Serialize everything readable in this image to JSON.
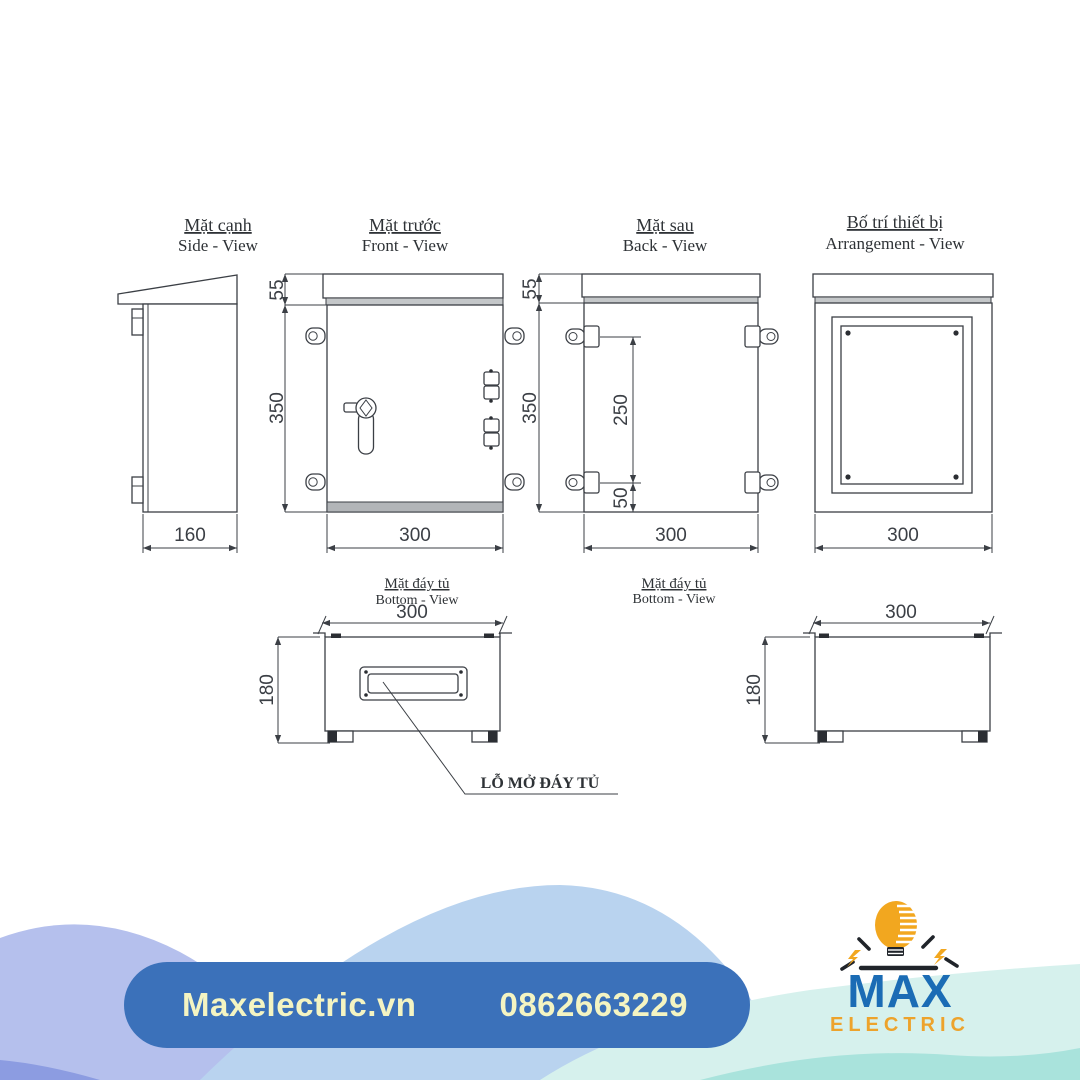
{
  "views": {
    "side": {
      "title_vi": "Mặt cạnh",
      "title_en": "Side - View",
      "dim_width": "160"
    },
    "front": {
      "title_vi": "Mặt trước",
      "title_en": "Front - View",
      "dim_roof": "55",
      "dim_height": "350",
      "dim_width": "300"
    },
    "back": {
      "title_vi": "Mặt sau",
      "title_en": "Back - View",
      "dim_roof": "55",
      "dim_height": "350",
      "dim_lug_span": "250",
      "dim_lug_offset": "50",
      "dim_width": "300"
    },
    "arrangement": {
      "title_vi": "Bố trí thiết bị",
      "title_en": "Arrangement - View",
      "dim_width": "300"
    },
    "bottom1": {
      "title_vi": "Mặt đáy tủ",
      "title_en": "Bottom - View",
      "dim_width": "300",
      "dim_depth": "180",
      "callout": "LỖ MỞ ĐÁY TỦ"
    },
    "bottom2": {
      "title_vi": "Mặt đáy tủ",
      "title_en": "Bottom - View",
      "dim_width": "300",
      "dim_depth": "180"
    }
  },
  "footer": {
    "website": "Maxelectric.vn",
    "phone": "0862663229"
  },
  "logo": {
    "name": "MAX",
    "subtitle": "ELECTRIC"
  },
  "colors": {
    "pill_blue": "#3b71ba",
    "pill_text": "#f4f4c2",
    "logo_blue": "#1b6cb5",
    "logo_orange": "#eda32c",
    "bulb_orange": "#f2a71f",
    "wave_periwinkle": "#b5c0ed",
    "wave_periwinkle_dark": "#8c9ce1",
    "wave_lightblue": "#b9d3ef",
    "wave_teal_light": "#d6f1ed",
    "wave_teal": "#a9e3dc",
    "line_color": "#3b3f45"
  }
}
